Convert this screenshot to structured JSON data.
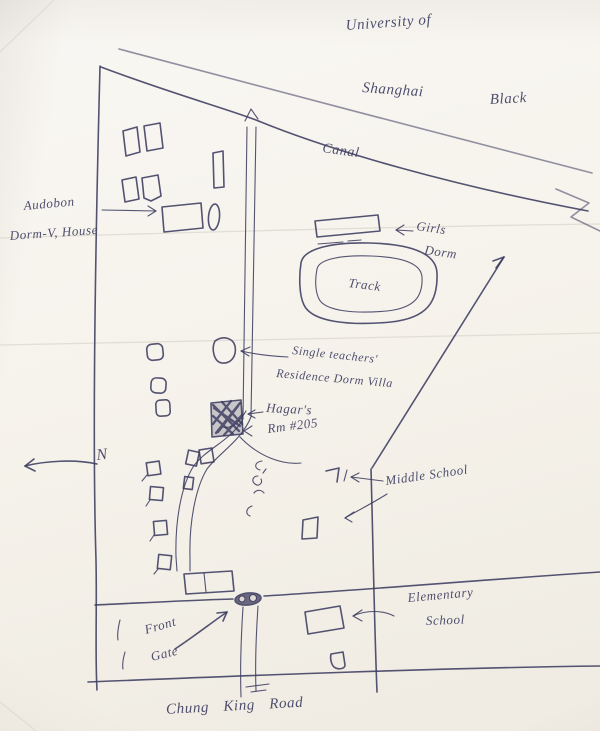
{
  "labels": {
    "university_line1": "University of",
    "university_line2": "Shanghai",
    "note_black": "Black",
    "canal": "Canal",
    "west_line1": "Audobon",
    "west_line2": "Dorm-V, House",
    "girls_dorm_line1": "Girls",
    "girls_dorm_line2": "Dorm",
    "track": "Track",
    "teachers_line1": "Single teachers'",
    "teachers_line2": "Residence Dorm Villa",
    "hagars_line1": "Hagar's",
    "hagars_line2": "Rm #205",
    "middle_school": "Middle School",
    "elementary_line1": "Elementary",
    "elementary_line2": "School",
    "front_gate_line1": "Front",
    "front_gate_line2": "Gate",
    "compass_north": "N",
    "bottom_road": "Chung King Road"
  },
  "colors": {
    "ink": "#3c3c60",
    "paper": "#f7f4ee"
  }
}
